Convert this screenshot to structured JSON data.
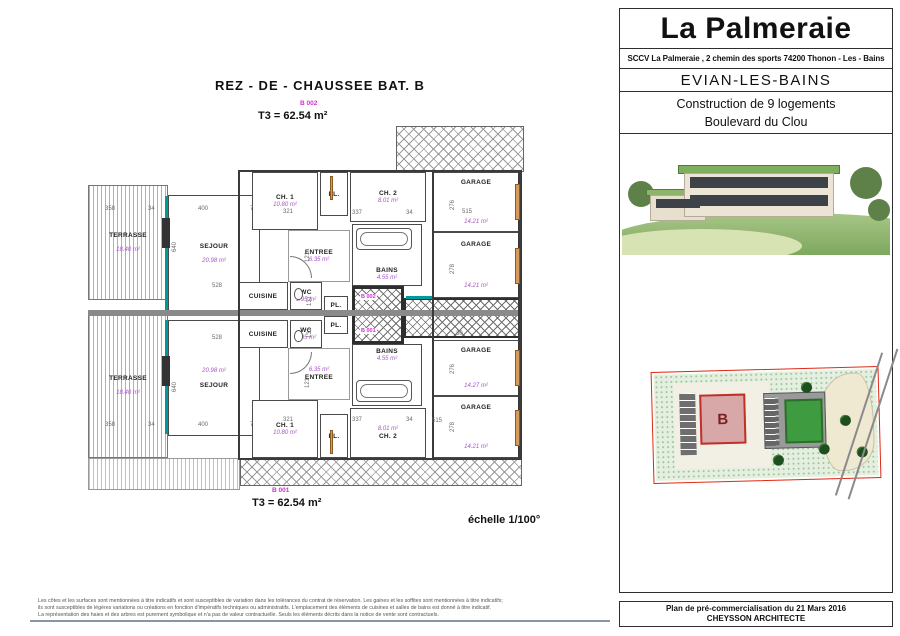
{
  "plan": {
    "title": "REZ - DE - CHAUSSEE   BAT. B",
    "scale_label": "échelle 1/100°",
    "apartments": [
      {
        "id": "B 002",
        "area_label": "T3 = 62.54 m²"
      },
      {
        "id": "B 001",
        "area_label": "T3 = 62.54 m²"
      }
    ],
    "hall_labels": [
      "B 002",
      "B 001"
    ],
    "rooms": [
      {
        "name": "TERRASSE",
        "area": "18.40 m²"
      },
      {
        "name": "SEJOUR",
        "area": "20.98 m²"
      },
      {
        "name": "CH. 1",
        "area": "10.80 m²"
      },
      {
        "name": "PL.",
        "area": ""
      },
      {
        "name": "CH. 2",
        "area": "8.01 m²"
      },
      {
        "name": "ENTREE",
        "area": "6.35 m²"
      },
      {
        "name": "BAINS",
        "area": "4.55 m²"
      },
      {
        "name": "CUISINE",
        "area": ""
      },
      {
        "name": "WC",
        "area": "1.95 m²"
      },
      {
        "name": "PL.",
        "area": ""
      },
      {
        "name": "TERRASSE",
        "area": "18.40 m²"
      },
      {
        "name": "SEJOUR",
        "area": "20.98 m²"
      },
      {
        "name": "CUISINE",
        "area": ""
      },
      {
        "name": "WC",
        "area": "1.95 m²"
      },
      {
        "name": "PL.",
        "area": ""
      },
      {
        "name": "ENTREE",
        "area": "6.35 m²"
      },
      {
        "name": "BAINS",
        "area": "4.55 m²"
      },
      {
        "name": "CH. 1",
        "area": "10.80 m²"
      },
      {
        "name": "PL.",
        "area": ""
      },
      {
        "name": "CH. 2",
        "area": "8.01 m²"
      },
      {
        "name": "GARAGE",
        "area": "14.21 m²"
      },
      {
        "name": "GARAGE",
        "area": "14.21 m²"
      },
      {
        "name": "GARAGE",
        "area": "14.27 m²"
      },
      {
        "name": "GARAGE",
        "area": "14.21 m²"
      }
    ],
    "dimensions": [
      "358",
      "34",
      "400",
      "7",
      "640",
      "528",
      "321",
      "337",
      "34",
      "515",
      "276",
      "278",
      "30",
      "121",
      "131",
      "131",
      "121",
      "528",
      "321",
      "337",
      "34",
      "400",
      "7",
      "358",
      "34",
      "640",
      "276",
      "278",
      "515"
    ]
  },
  "title_block": {
    "project_name": "La Palmeraie",
    "company_line": "SCCV La Palmeraie , 2 chemin des sports 74200 Thonon - Les - Bains",
    "city": "EVIAN-LES-BAINS",
    "project_desc": "Construction de 9 logements",
    "street": "Boulevard du Clou",
    "footer_line1": "Plan de pré-commercialisation du 21 Mars 2016",
    "footer_line2": "CHEYSSON ARCHITECTE"
  },
  "site_plan": {
    "building_label": "B"
  },
  "disclaimer": {
    "line1": "Les côtes et les surfaces sont mentionnées à titre indicatifs et sont susceptibles de variation dans les tolérances du contrat de réservation. Les gaines et les soffites sont mentionnées à titre indicatifs;",
    "line2": "ils sont susceptibles de légères variations ou créations en fonction d'impératifs techniques ou administratifs. L'emplacement des éléments de cuisines et salles de bains est donné à titre indicatif.",
    "line3": "La représentation des haies et des arbres est purement symbolique et n'a pas de valeur contractuelle. Seuls les éléments décrits dans la notice de vente sont contractuels."
  }
}
